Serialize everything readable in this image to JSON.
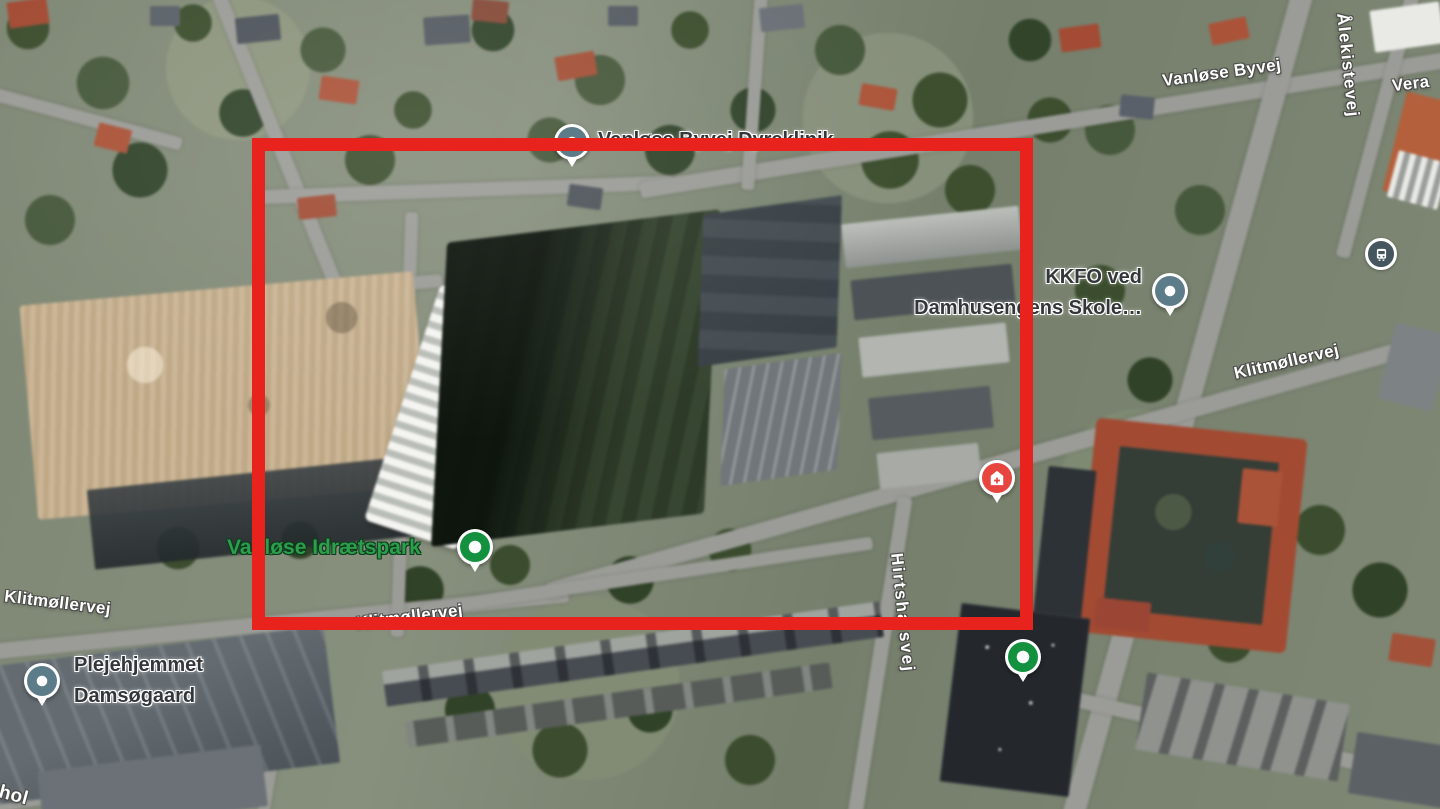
{
  "map": {
    "view": "satellite",
    "annotation": {
      "shape": "rectangle",
      "color": "#e8221c"
    }
  },
  "labels": {
    "street": {
      "vanlose_byvej": "Vanløse Byvej",
      "alekistevej": "Ålekistevej",
      "vera_partial": "Vera",
      "klitmollervej_right": "Klitmøllervej",
      "klitmollervej_left": "Klitmøllervej",
      "klitmollervej_center": "Klitmøllervej",
      "hirtshalsvej": "Hirtshalsvej",
      "corner_partial": "thol"
    },
    "poi": {
      "dyreklinik": "Vanløse Byvej Dyreklinik",
      "kkfo_line1": "KKFO ved",
      "kkfo_line2": "Damhusengens Skole…",
      "idraetspark": "Vanløse Idrætspark",
      "plejehjemmet_line1": "Plejehjemmet",
      "plejehjemmet_line2": "Damsøgaard"
    }
  },
  "icons": {
    "poi_pin": "map-pin",
    "park_pin": "map-pin-green",
    "health_pin": "medical-house-pin",
    "bus_stop": "bus-stop-icon"
  },
  "colors": {
    "highlight_rectangle": "#e8221c",
    "park_pin_green": "#13913f",
    "poi_pin_slate": "#5d7c8a",
    "health_pin_red": "#e64540",
    "bus_icon_navy": "#46565e",
    "poi_text": "#33373a",
    "park_text": "#2d9e4b",
    "street_text": "#ffffff"
  }
}
